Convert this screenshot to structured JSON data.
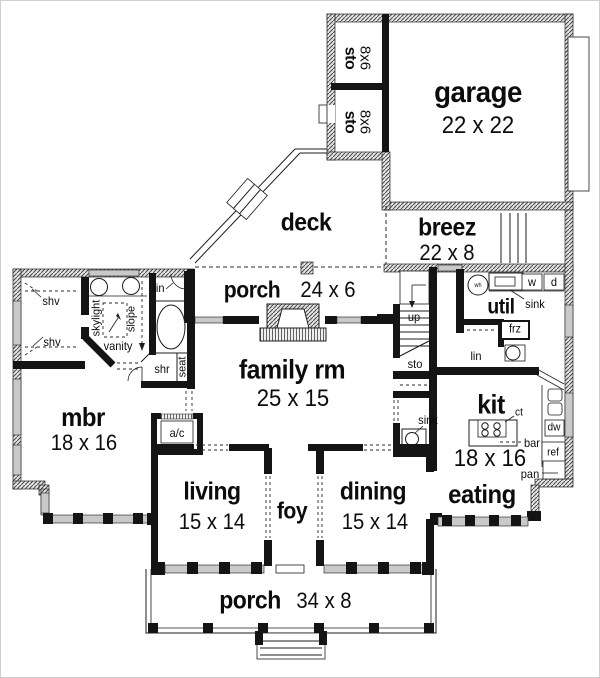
{
  "plan": {
    "type": "floor-plan",
    "style": "black-line architectural drawing"
  },
  "colors": {
    "wall": "#141414",
    "background": "#ffffff",
    "window_fill": "#c9c9c9"
  },
  "rooms": {
    "garage": {
      "name": "garage",
      "dims": "22 x 22"
    },
    "sto_upper": {
      "name": "sto",
      "dims": "8x6"
    },
    "sto_lower": {
      "name": "sto",
      "dims": "8x6"
    },
    "deck": {
      "name": "deck",
      "dims": ""
    },
    "breez": {
      "name": "breez",
      "dims": "22 x 8"
    },
    "porch_rear": {
      "name": "porch",
      "dims": "24 x 6"
    },
    "family_rm": {
      "name": "family rm",
      "dims": "25 x 15"
    },
    "mbr": {
      "name": "mbr",
      "dims": "18 x 16"
    },
    "util": {
      "name": "util",
      "dims": ""
    },
    "kit": {
      "name": "kit",
      "dims": "18 x 16"
    },
    "eating": {
      "name": "eating",
      "dims": ""
    },
    "living": {
      "name": "living",
      "dims": "15 x 14"
    },
    "foy": {
      "name": "foy",
      "dims": ""
    },
    "dining": {
      "name": "dining",
      "dims": "15 x 14"
    },
    "porch_front": {
      "name": "porch",
      "dims": "34 x 8"
    }
  },
  "ann": {
    "up": "up",
    "stair_sto": "sto",
    "hall_sink": "sink",
    "util_sink": "sink",
    "washer": "w",
    "dryer": "d",
    "freezer": "frz",
    "util_linen": "lin",
    "water_heater": "wh",
    "counter": "ct",
    "bar": "bar",
    "pantry": "pan",
    "dishwasher": "dw",
    "refrigerator": "ref",
    "shelves_upper": "shv",
    "shelves_lower": "shv",
    "skylight": "skylight",
    "vanity": "vanity",
    "slope": "slope",
    "bath_linen": "lin",
    "shower": "shr",
    "seat": "seat",
    "ac": "a/c"
  }
}
